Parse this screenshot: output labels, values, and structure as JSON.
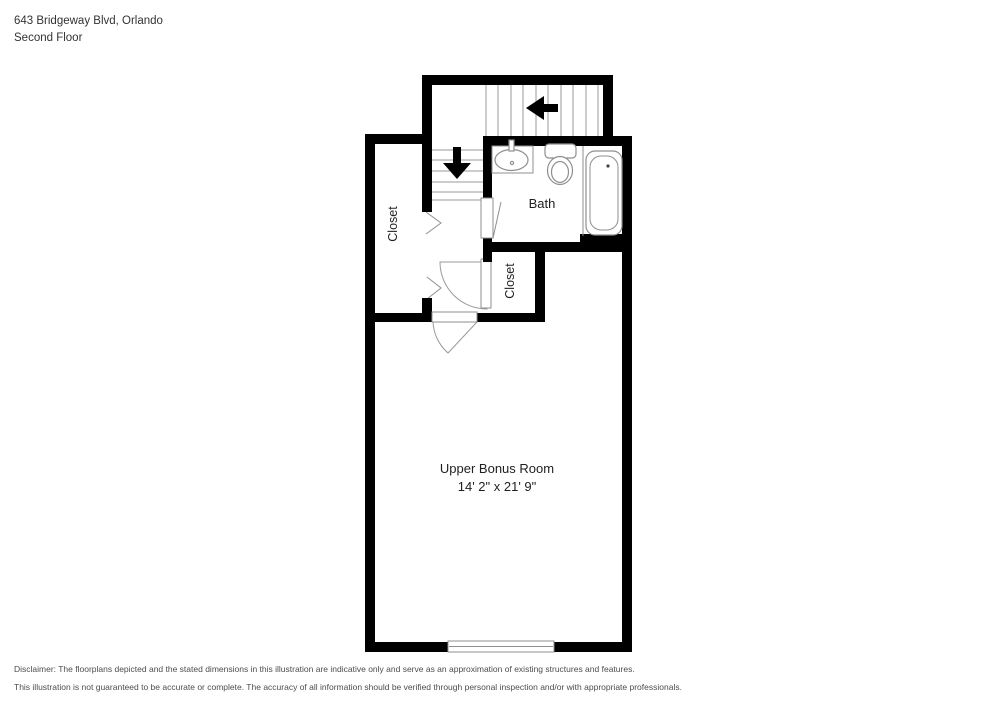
{
  "header": {
    "address": "643 Bridgeway Blvd, Orlando",
    "floor_label": "Second Floor"
  },
  "floor_plan": {
    "rooms": {
      "bath_label": "Bath",
      "closet_left_label": "Closet",
      "closet_small_label": "Closet",
      "bonus_room_label": "Upper Bonus Room",
      "bonus_room_dimensions": "14' 2\" x 21' 9\""
    },
    "colors": {
      "wall": "#000000",
      "fixture_line": "#8f8f8f",
      "label_text": "#1f1f1f"
    }
  },
  "disclaimer": {
    "line1": "Disclaimer: The floorplans depicted and the stated dimensions in this illustration are indicative only and serve as an approximation of existing structures and features.",
    "line2": "This illustration is not guaranteed to be accurate or complete. The accuracy of all information should be verified through personal inspection and/or with appropriate professionals."
  }
}
